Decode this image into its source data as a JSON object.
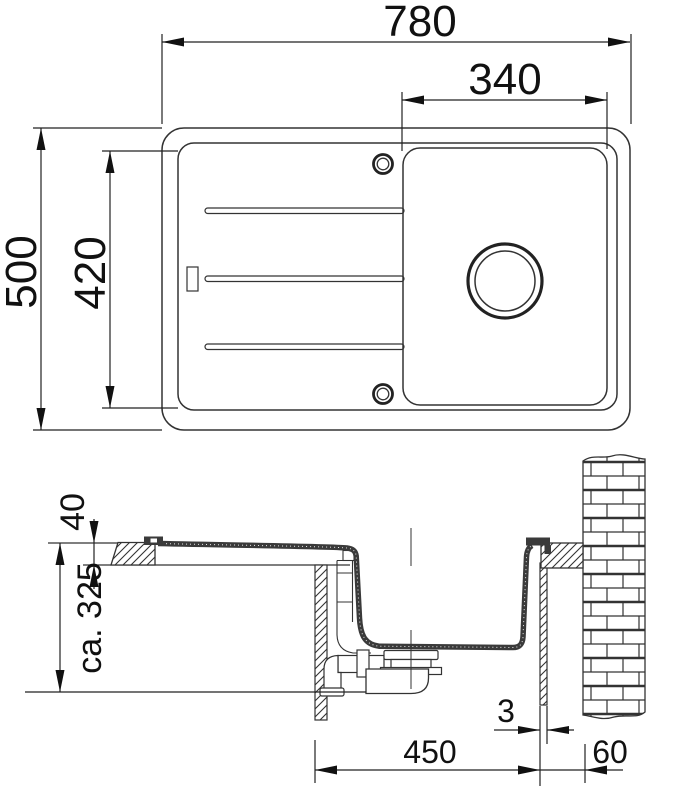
{
  "top_view": {
    "width": "780",
    "bowl_width": "340",
    "depth": "500",
    "inner_depth": "420"
  },
  "section_view": {
    "counter_thickness": "40",
    "mounting_depth": "ca. 325",
    "gap": "3",
    "cabinet_width": "450",
    "wall_clearance": "60"
  },
  "colors": {
    "line": "#333333",
    "text": "#111111",
    "sink_material": "#3a3a3a",
    "background": "#ffffff"
  }
}
